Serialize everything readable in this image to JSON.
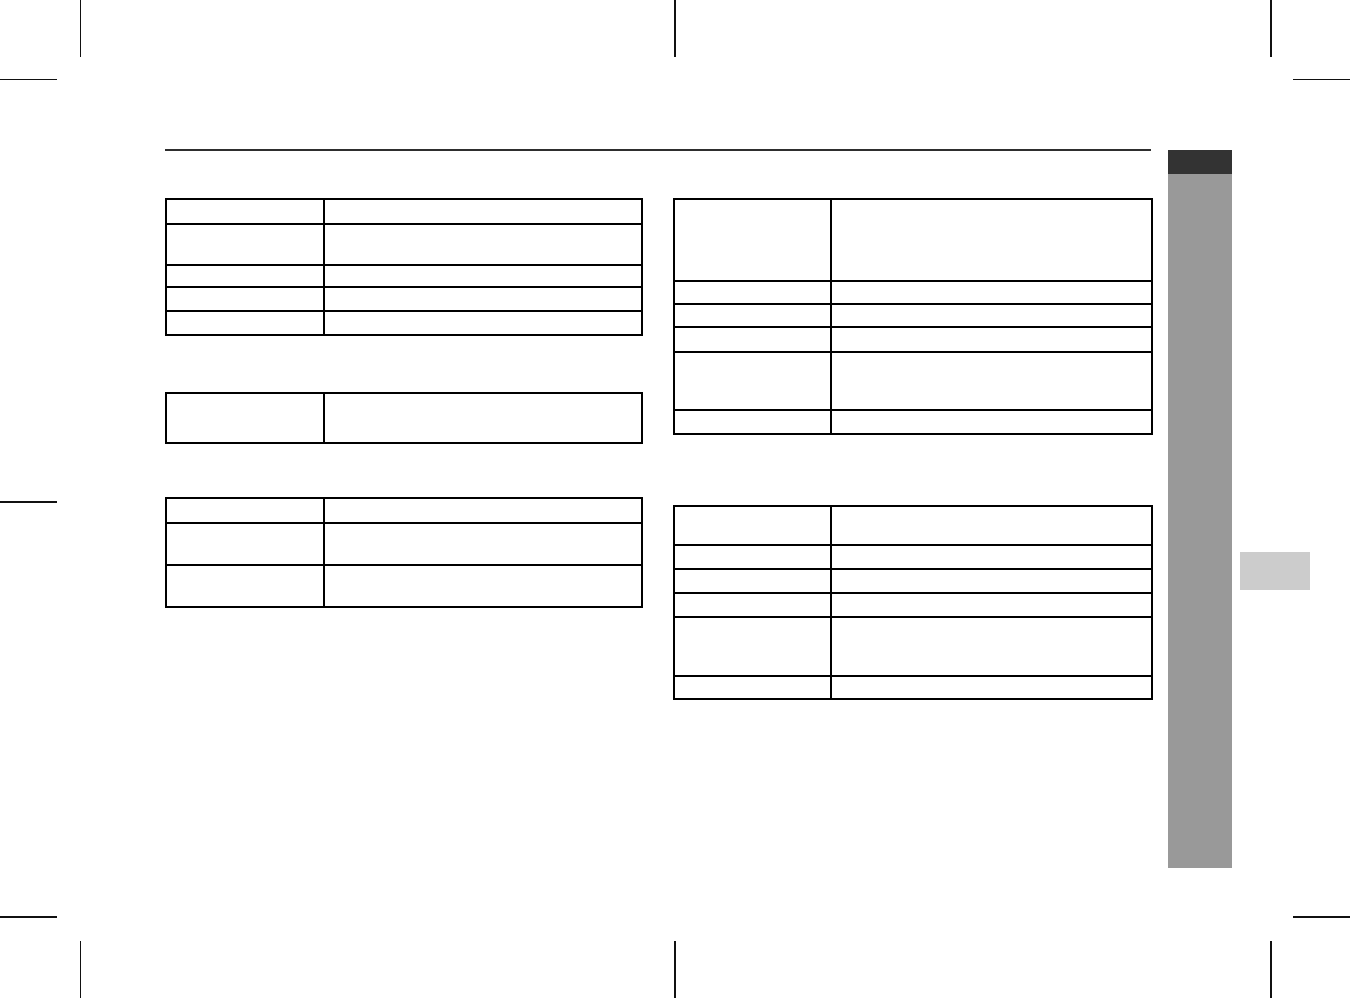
{
  "page": {
    "width": 1350,
    "height": 998,
    "background": "#ffffff"
  },
  "colors": {
    "page_bg": "#ffffff",
    "rule": "#2e2e2e",
    "table_border": "#000000",
    "chapter_tab": "#333333",
    "chapter_bar": "#999999",
    "side_tab": "#cccccc",
    "crop_mark": "#111111"
  },
  "tables": {
    "left_top": {
      "rows": [
        {
          "label": "",
          "value": ""
        },
        {
          "label": "",
          "value": ""
        },
        {
          "label": "",
          "value": ""
        },
        {
          "label": "",
          "value": ""
        },
        {
          "label": "",
          "value": ""
        }
      ]
    },
    "left_middle": {
      "rows": [
        {
          "label": "",
          "value": ""
        }
      ]
    },
    "left_bottom": {
      "rows": [
        {
          "label": "",
          "value": ""
        },
        {
          "label": "",
          "value": ""
        },
        {
          "label": "",
          "value": ""
        }
      ]
    },
    "right_top": {
      "rows": [
        {
          "label": "",
          "value": ""
        },
        {
          "label": "",
          "value": ""
        },
        {
          "label": "",
          "value": ""
        },
        {
          "label": "",
          "value": ""
        },
        {
          "label": "",
          "value": ""
        },
        {
          "label": "",
          "value": ""
        }
      ]
    },
    "right_bottom": {
      "rows": [
        {
          "label": "",
          "value": ""
        },
        {
          "label": "",
          "value": ""
        },
        {
          "label": "",
          "value": ""
        },
        {
          "label": "",
          "value": ""
        },
        {
          "label": "",
          "value": ""
        },
        {
          "label": "",
          "value": ""
        }
      ]
    }
  }
}
